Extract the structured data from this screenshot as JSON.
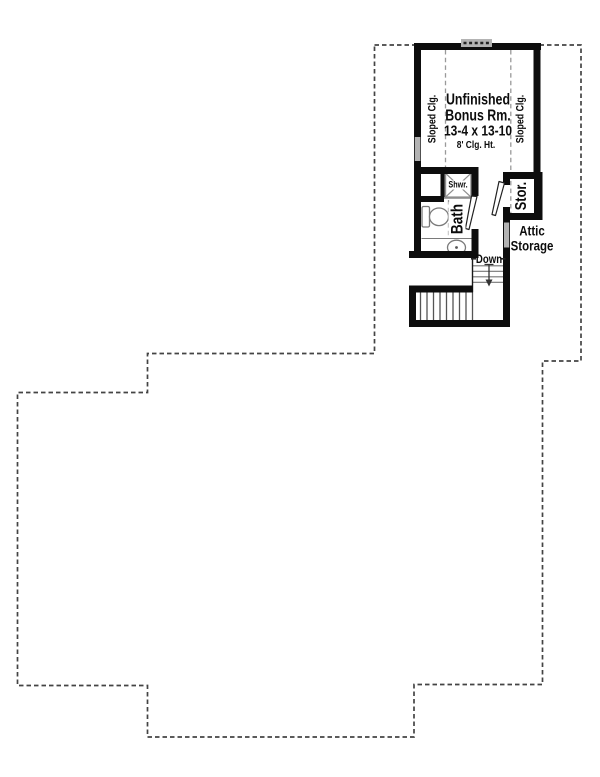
{
  "floor_plan": {
    "bonus_room": {
      "name_line1": "Unfinished",
      "name_line2": "Bonus Rm.",
      "dimensions": "13-4 x 13-10",
      "ceiling_height": "8' Clg. Ht.",
      "sloped_ceiling_left": "Sloped Clg.",
      "sloped_ceiling_right": "Sloped Clg."
    },
    "bathroom": {
      "label": "Bath",
      "shower_label": "Shwr."
    },
    "storage": {
      "closet_label": "Stor.",
      "attic_line1": "Attic",
      "attic_line2": "Storage"
    },
    "stairs": {
      "down_label": "Down"
    },
    "colors": {
      "wall": "#0d0d0d",
      "footprint_dash": "#444444",
      "fixture_gray": "#8e8e8e",
      "window_gray": "#b3b3b3",
      "text": "#0c0c0c"
    }
  }
}
